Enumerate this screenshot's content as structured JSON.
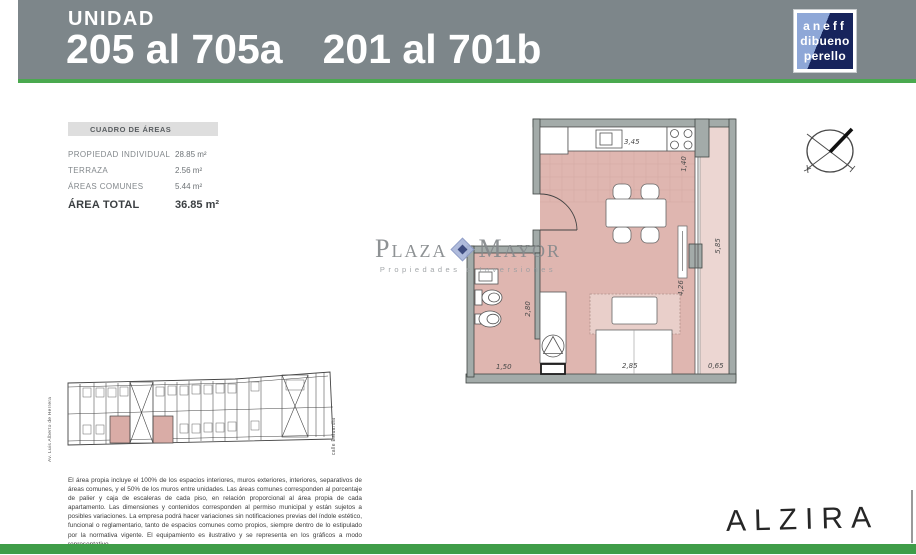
{
  "header": {
    "title": "UNIDAD",
    "units_a": "205 al 705a",
    "units_b": "201 al 701b"
  },
  "architect_logo": {
    "line1": "aneff",
    "line2": "dibueno",
    "line3": "perello"
  },
  "areas_table": {
    "title": "CUADRO DE ÁREAS",
    "rows": [
      {
        "label": "PROPIEDAD INDIVIDUAL",
        "value": "28.85 m²"
      },
      {
        "label": "TERRAZA",
        "value": "2.56 m²"
      },
      {
        "label": "ÁREAS COMUNES",
        "value": "5.44 m²"
      }
    ],
    "total_label": "ÁREA TOTAL",
    "total_value": "36.85 m²"
  },
  "watermark": {
    "word1": "Plaza",
    "word2": "Mayor",
    "subtitle": "Propiedades e Inversiones"
  },
  "floorplan": {
    "dims": {
      "kitchen_width": "3,45",
      "balcony_door": "1,40",
      "terrace_length": "5,85",
      "window_height": "4,26",
      "bed_width": "2,85",
      "terrace_width": "0,65",
      "bath_width": "1,50",
      "bath_length": "2,80"
    }
  },
  "siteplan": {
    "street_left": "Av. Luis Alberto de Herrera",
    "street_right": "calle Estuardia"
  },
  "disclaimer": "El área propia incluye el 100% de los espacios interiores, muros exteriores, interiores, separativos de áreas comunes, y el 50% de los muros entre unidades. Las áreas comunes corresponden al porcentaje de palier y caja de escaleras de cada piso, en relación proporcional al área propia de cada apartamento. Las dimensiones y contenidos corresponden al permiso municipal y están sujetos a posibles variaciones. La empresa podrá hacer variaciones sin notificaciones previas del índole estético, funcional o reglamentario, tanto de espacios comunes como propios, siempre dentro de lo estipulado por la normativa vigente. El equipamiento es ilustrativo y se representa en los gráficos a modo representativo.",
  "brand": {
    "name": "ALZIRA"
  },
  "colors": {
    "header_gray": "#7d868a",
    "accent_green": "#4aa94f",
    "footer_green": "#3f9d48",
    "floor_pink": "#dfb6b0",
    "terrace_pink": "#ecd6d2",
    "wall_gray": "#a3aba9",
    "logo_light_blue": "#8ea7d7",
    "logo_dark_blue": "#17245c"
  }
}
